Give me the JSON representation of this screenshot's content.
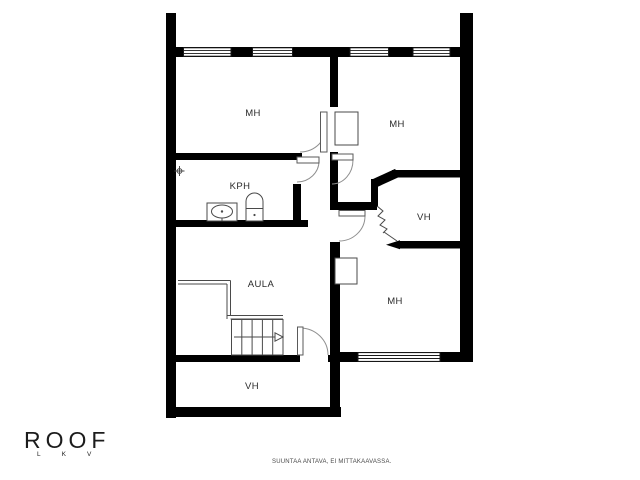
{
  "rooms": [
    {
      "name": "bedroom-top-left",
      "label": "MH"
    },
    {
      "name": "bathroom",
      "label": "KPH"
    },
    {
      "name": "hall",
      "label": "AULA"
    },
    {
      "name": "closet-bottom-left",
      "label": "VH"
    },
    {
      "name": "bedroom-top-right",
      "label": "MH"
    },
    {
      "name": "closet-right",
      "label": "VH"
    },
    {
      "name": "bedroom-bottom-right",
      "label": "MH"
    }
  ],
  "branding": {
    "logo": "ROOF",
    "logo_sub": "LKV"
  },
  "footer": {
    "disclaimer": "SUUNTAA ANTAVA, EI MITTAKAAVASSA."
  },
  "colors": {
    "wall": "#000000",
    "background": "#ffffff",
    "thin_line": "#4a4a4a",
    "door_arc": "#8f8f8f",
    "label": "#2b2b2b",
    "logo": "#1c1c1c",
    "disclaimer": "#4a4a4a"
  }
}
